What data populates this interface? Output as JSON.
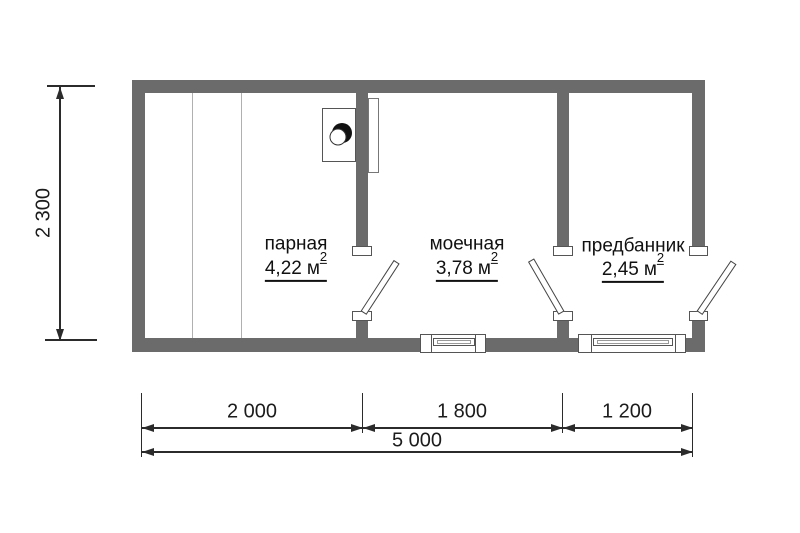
{
  "plan": {
    "type": "bathhouse-floor-plan",
    "rooms": [
      {
        "name": "парная",
        "area_value": "4,22",
        "area_unit": "м",
        "area_sup": "2"
      },
      {
        "name": "моечная",
        "area_value": "3,78",
        "area_unit": "м",
        "area_sup": "2"
      },
      {
        "name": "предбанник",
        "area_value": "2,45",
        "area_unit": "м",
        "area_sup": "2"
      }
    ],
    "dimensions": {
      "left_height": "2 300",
      "segments": [
        "2 000",
        "1 800",
        "1 200"
      ],
      "total_width": "5 000"
    },
    "icons": {
      "stove": "circle-half-filled-stove-symbol"
    },
    "colors": {
      "wall": "#6b6b6b",
      "dimension_line": "#2b2b2b",
      "text": "#111111",
      "bench_line": "#b0b0b0",
      "background": "#ffffff"
    }
  }
}
